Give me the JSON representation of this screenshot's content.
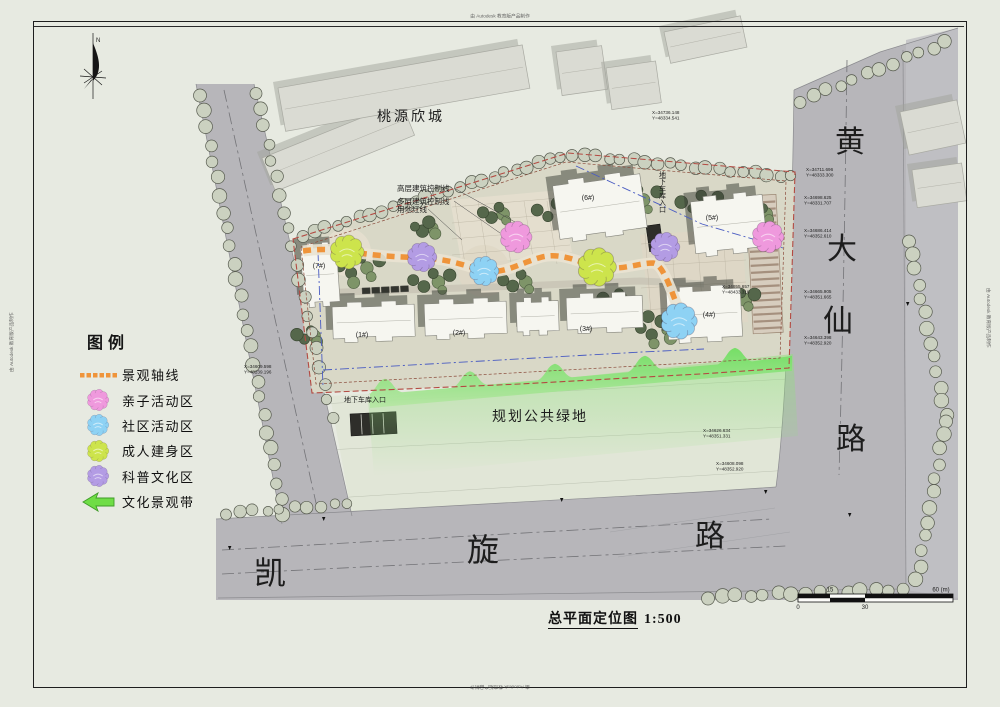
{
  "watermarks": {
    "top": "由 Autodesk 教育版产品制作",
    "bottom": "由 Autodesk 教育版产品制作",
    "left": "由 Autodesk 教育版产品制作",
    "right": "由 Autodesk 教育版产品制作"
  },
  "compass": {
    "label": "N"
  },
  "legend": {
    "title": "图例",
    "items": [
      {
        "label": "景观轴线",
        "type": "axis"
      },
      {
        "label": "亲子活动区",
        "type": "flower",
        "color": "pink"
      },
      {
        "label": "社区活动区",
        "type": "flower",
        "color": "blue"
      },
      {
        "label": "成人建身区",
        "type": "flower",
        "color": "green"
      },
      {
        "label": "科普文化区",
        "type": "flower",
        "color": "purple"
      },
      {
        "label": "文化景观带",
        "type": "arrow"
      }
    ]
  },
  "title": {
    "text": "总平面定位图",
    "scale": "1:500"
  },
  "scale_bar": {
    "zero": "0",
    "fifteen": "15",
    "thirty": "30",
    "sixty": "60 (m)"
  },
  "plan": {
    "road_right": {
      "name": "黄大仙路",
      "chars": [
        {
          "ch": "黄",
          "x": 850,
          "y": 152,
          "s": 30
        },
        {
          "ch": "大",
          "x": 842,
          "y": 259,
          "s": 30
        },
        {
          "ch": "仙",
          "x": 838,
          "y": 331,
          "s": 30
        },
        {
          "ch": "路",
          "x": 851,
          "y": 449,
          "s": 30
        }
      ]
    },
    "road_bottom": {
      "name": "凯旋路",
      "chars": [
        {
          "ch": "凯",
          "x": 270,
          "y": 584,
          "s": 32
        },
        {
          "ch": "旋",
          "x": 483,
          "y": 561,
          "s": 32
        },
        {
          "ch": "路",
          "x": 710,
          "y": 546,
          "s": 30
        }
      ]
    },
    "labels": [
      {
        "id": "estate-name",
        "text": "桃源欣城",
        "x": 411,
        "y": 121,
        "s": 14,
        "serif": true,
        "ls": 3
      },
      {
        "id": "public-green",
        "text": "规划公共绿地",
        "x": 540,
        "y": 421,
        "s": 14,
        "serif": true,
        "ls": 2
      },
      {
        "id": "ctrl-highrise",
        "text": "高层建筑控制线",
        "x": 397,
        "y": 191,
        "s": 7.5,
        "anchor": "start"
      },
      {
        "id": "ctrl-multistorey",
        "text": "多层建筑控制线",
        "x": 397,
        "y": 204,
        "s": 7.5,
        "anchor": "start"
      },
      {
        "id": "red-line",
        "text": "用地红线",
        "x": 397,
        "y": 212,
        "s": 7.5,
        "anchor": "start"
      },
      {
        "id": "garage-entrance-south",
        "text": "地下车库入口",
        "x": 365,
        "y": 402,
        "s": 7
      },
      {
        "id": "garage-entrance-north",
        "text": "地下车库入口",
        "x": 662,
        "y": 192,
        "s": 7,
        "vertical": true
      }
    ],
    "buildings": [
      {
        "label": "(7#)",
        "x": 319,
        "y": 268
      },
      {
        "label": "(1#)",
        "x": 362,
        "y": 337
      },
      {
        "label": "(2#)",
        "x": 459,
        "y": 335
      },
      {
        "label": "(3#)",
        "x": 586,
        "y": 331
      },
      {
        "label": "(4#)",
        "x": 709,
        "y": 317
      },
      {
        "label": "(6#)",
        "x": 588,
        "y": 200
      },
      {
        "label": "(5#)",
        "x": 712,
        "y": 220
      }
    ],
    "coords": [
      {
        "x": 244,
        "y": 368,
        "l1": "X=34609.598",
        "l2": "Y=48239.196"
      },
      {
        "x": 652,
        "y": 114,
        "l1": "X=34736.148",
        "l2": "Y=48334.541"
      },
      {
        "x": 806,
        "y": 171,
        "l1": "X=34711.696",
        "l2": "Y=48333.300"
      },
      {
        "x": 804,
        "y": 199,
        "l1": "X=34698.625",
        "l2": "Y=48331.707"
      },
      {
        "x": 804,
        "y": 232,
        "l1": "X=34686.414",
        "l2": "Y=48352.610"
      },
      {
        "x": 804,
        "y": 293,
        "l1": "X=34665.905",
        "l2": "Y=48351.665"
      },
      {
        "x": 804,
        "y": 339,
        "l1": "X=34643.398",
        "l2": "Y=48352.920"
      },
      {
        "x": 703,
        "y": 432,
        "l1": "X=34626.634",
        "l2": "Y=48351.331"
      },
      {
        "x": 716,
        "y": 465,
        "l1": "X=34608.098",
        "l2": "Y=48352.920"
      },
      {
        "x": 722,
        "y": 288,
        "l1": "X=34655.657",
        "l2": "Y=48433.318"
      }
    ],
    "flowers": [
      {
        "x": 347,
        "y": 252,
        "r": 15,
        "color": "green"
      },
      {
        "x": 422,
        "y": 257,
        "r": 13,
        "color": "purple"
      },
      {
        "x": 484,
        "y": 271,
        "r": 13,
        "color": "blue"
      },
      {
        "x": 516,
        "y": 237,
        "r": 14,
        "color": "pink"
      },
      {
        "x": 597,
        "y": 267,
        "r": 17,
        "color": "green"
      },
      {
        "x": 665,
        "y": 247,
        "r": 13,
        "color": "purple"
      },
      {
        "x": 768,
        "y": 237,
        "r": 14,
        "color": "pink"
      },
      {
        "x": 679,
        "y": 321,
        "r": 16,
        "color": "blue"
      }
    ]
  },
  "colors": {
    "paper": "#e7eae1",
    "road": "#b7b6ba",
    "site_ground": "#d9d8c7",
    "axis_orange": "#ef943a",
    "flower": {
      "pink": "#ef99dd",
      "blue": "#8ed2f4",
      "green": "#cde44c",
      "purple": "#b39ce4"
    },
    "band_green": "#77e266",
    "arrow_green": "#6fdd46",
    "red_boundary": "#b34a42",
    "blue_line": "#4a5cc2",
    "tree_pale": "#cbd1c0",
    "tree_dark": "#55674b",
    "building": "#f6f6f0"
  }
}
